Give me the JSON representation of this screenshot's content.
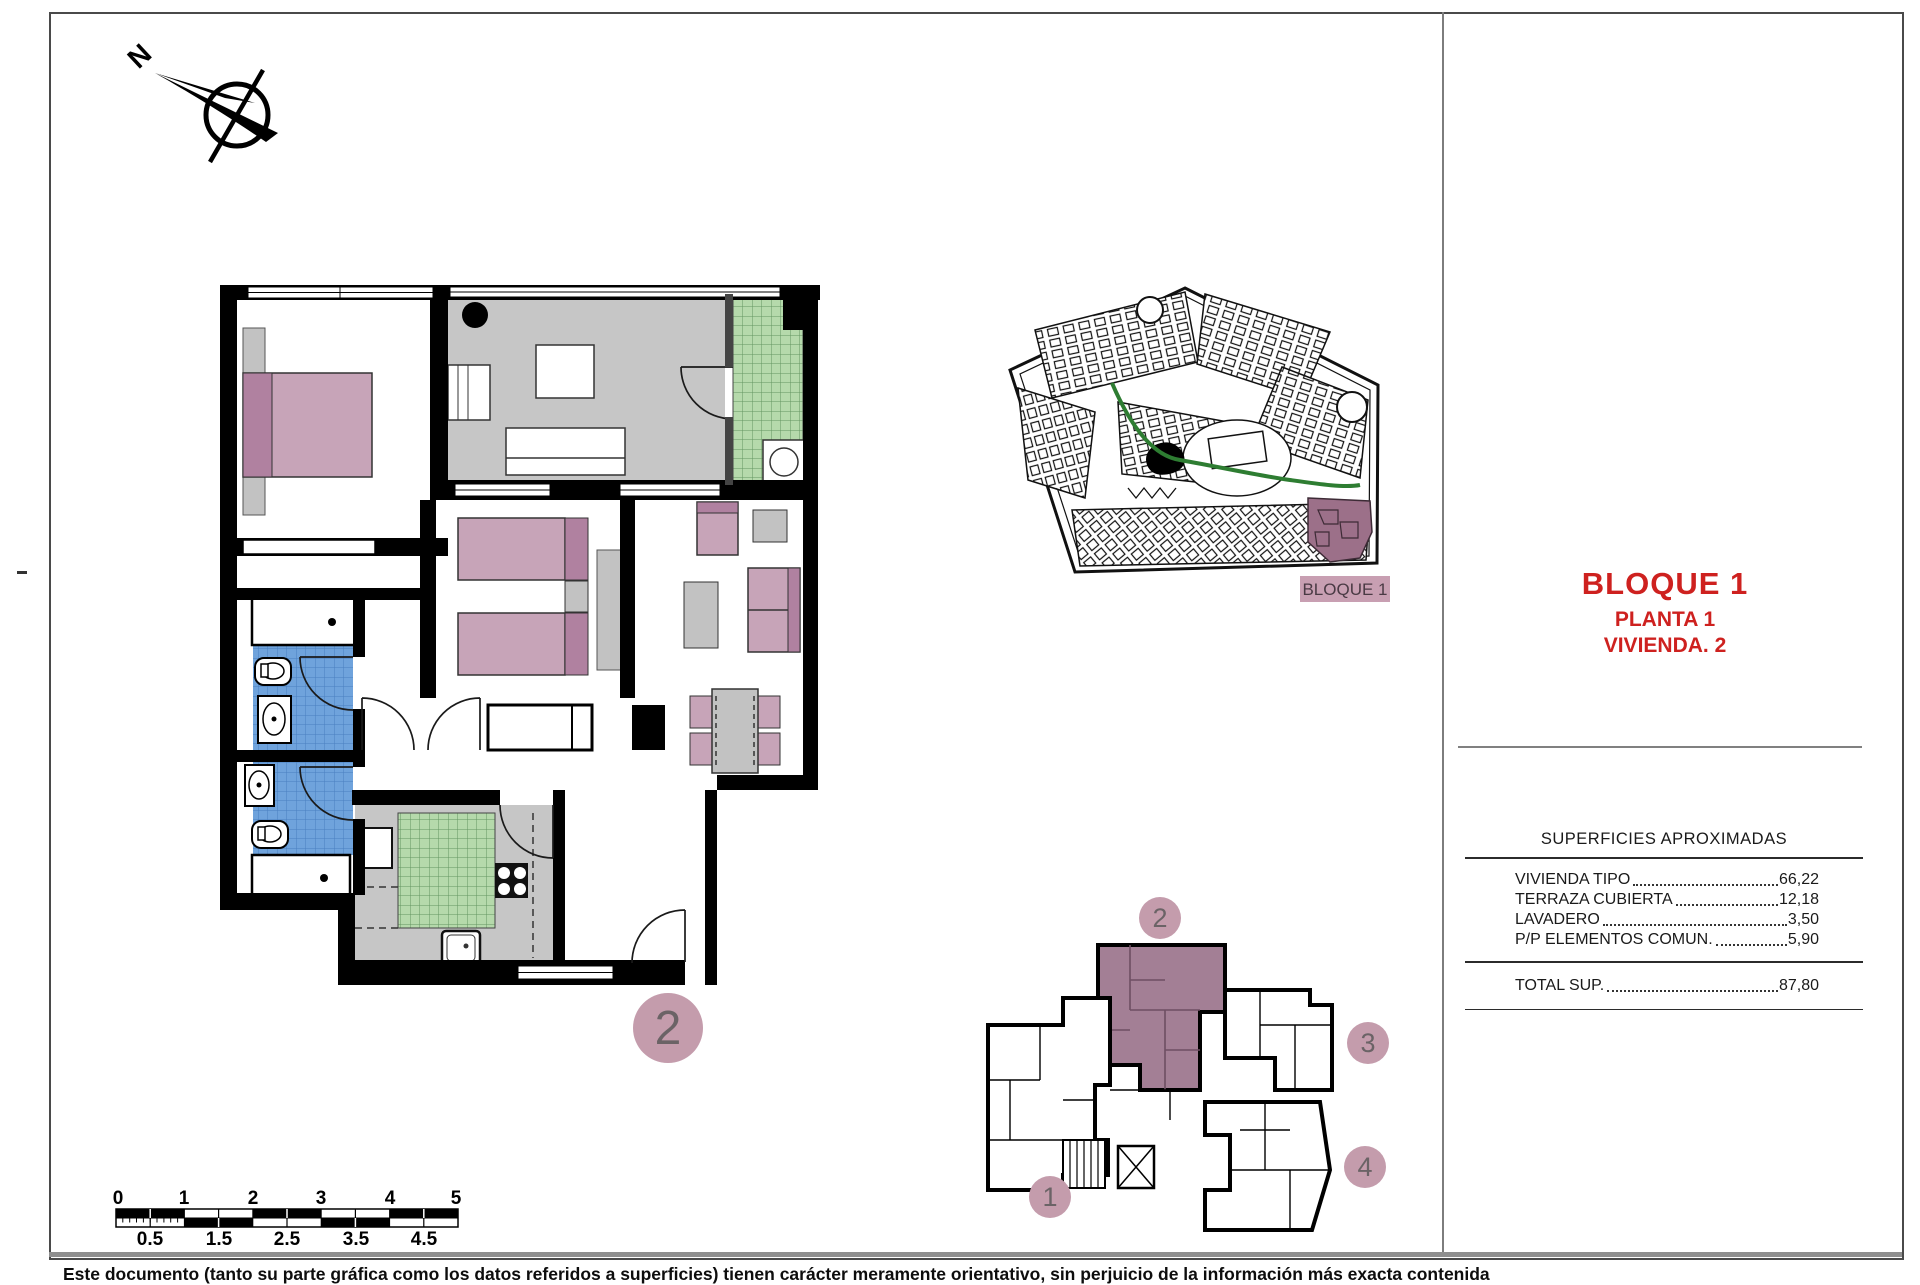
{
  "title_block": {
    "block": "BLOQUE 1",
    "floor": "PLANTA 1",
    "unit": "VIVIENDA. 2"
  },
  "surfaces": {
    "title": "SUPERFICIES APROXIMADAS",
    "rows": [
      {
        "label": "VIVIENDA TIPO",
        "value": "66,22"
      },
      {
        "label": "TERRAZA CUBIERTA",
        "value": "12,18"
      },
      {
        "label": "LAVADERO",
        "value": "3,50"
      },
      {
        "label": "P/P ELEMENTOS COMUN.",
        "value": "5,90"
      }
    ],
    "total": {
      "label": "TOTAL SUP.",
      "value": "87,80"
    }
  },
  "site_plan": {
    "label": "BLOQUE 1"
  },
  "floor_plan": {
    "unit_number": "2"
  },
  "key_plan": {
    "highlighted_unit": "2",
    "units": [
      {
        "number": "1"
      },
      {
        "number": "2"
      },
      {
        "number": "3"
      },
      {
        "number": "4"
      }
    ]
  },
  "compass": {
    "label": "N"
  },
  "scale_bar": {
    "numbers": [
      "0",
      "1",
      "2",
      "3",
      "4",
      "5"
    ],
    "half_labels": [
      "0.5",
      "1.5",
      "2.5",
      "3.5",
      "4.5"
    ]
  },
  "disclaimer": "Este documento (tanto su parte gráfica como los datos referidos a superficies) tienen carácter meramente orientativo, sin perjuicio de la información más exacta contenida",
  "colors": {
    "accent_red": "#ce211f",
    "highlight_mauve": "#c49cac",
    "site_block_mauve": "#9c7089",
    "furniture_pink": "#c7a4b8",
    "furniture_pink_dark": "#b081a0",
    "tile_blue": "#6fa3dc",
    "tile_green": "#b5d9ab",
    "floor_gray": "#c6c6c6",
    "wall_black": "#000000"
  }
}
